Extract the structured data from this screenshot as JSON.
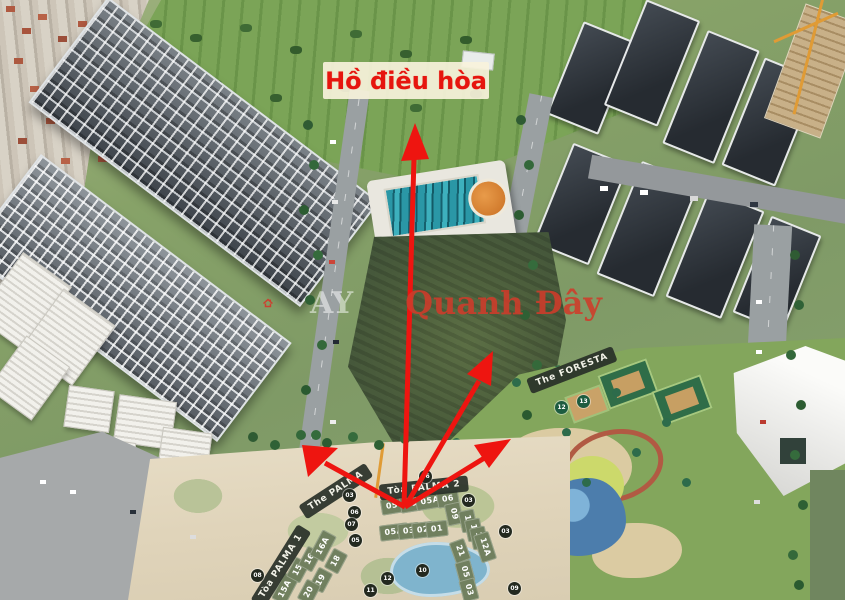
{
  "annotation": {
    "lake_label": "Hồ điều hòa",
    "arrow_color": "#ee1510"
  },
  "watermark": {
    "faint_text": "AY",
    "brand_text": "Quanh Đây"
  },
  "badges": {
    "the_palma": "The PALMA",
    "toa_palma_2": "Tòa PALMA 2",
    "toa_palma_1": "Tòa PALMA 1",
    "the_foresta": "The FORESTA"
  },
  "blocks": [
    "05",
    "06",
    "05A",
    "06",
    "09",
    "05A",
    "03",
    "02",
    "01",
    "15A",
    "15",
    "16",
    "16A",
    "18",
    "19",
    "20",
    "21",
    "10",
    "11",
    "12",
    "12A",
    "05",
    "03"
  ],
  "dark_markers": [
    "03",
    "06",
    "07",
    "06",
    "03",
    "03",
    "05",
    "08",
    "10",
    "11",
    "12",
    "09"
  ],
  "green_markers": [
    "12",
    "13"
  ],
  "colors": {
    "annotation_red": "#ee1510",
    "lake_label_bg": "#f7f2db",
    "lake_label_text": "#e6150e",
    "badge_bg": "#283028",
    "block_olive": "#71805f",
    "watermark_red": "#cf3b2a",
    "park_green": "#83a65c",
    "siteplan_cream": "#e0d4ba"
  }
}
